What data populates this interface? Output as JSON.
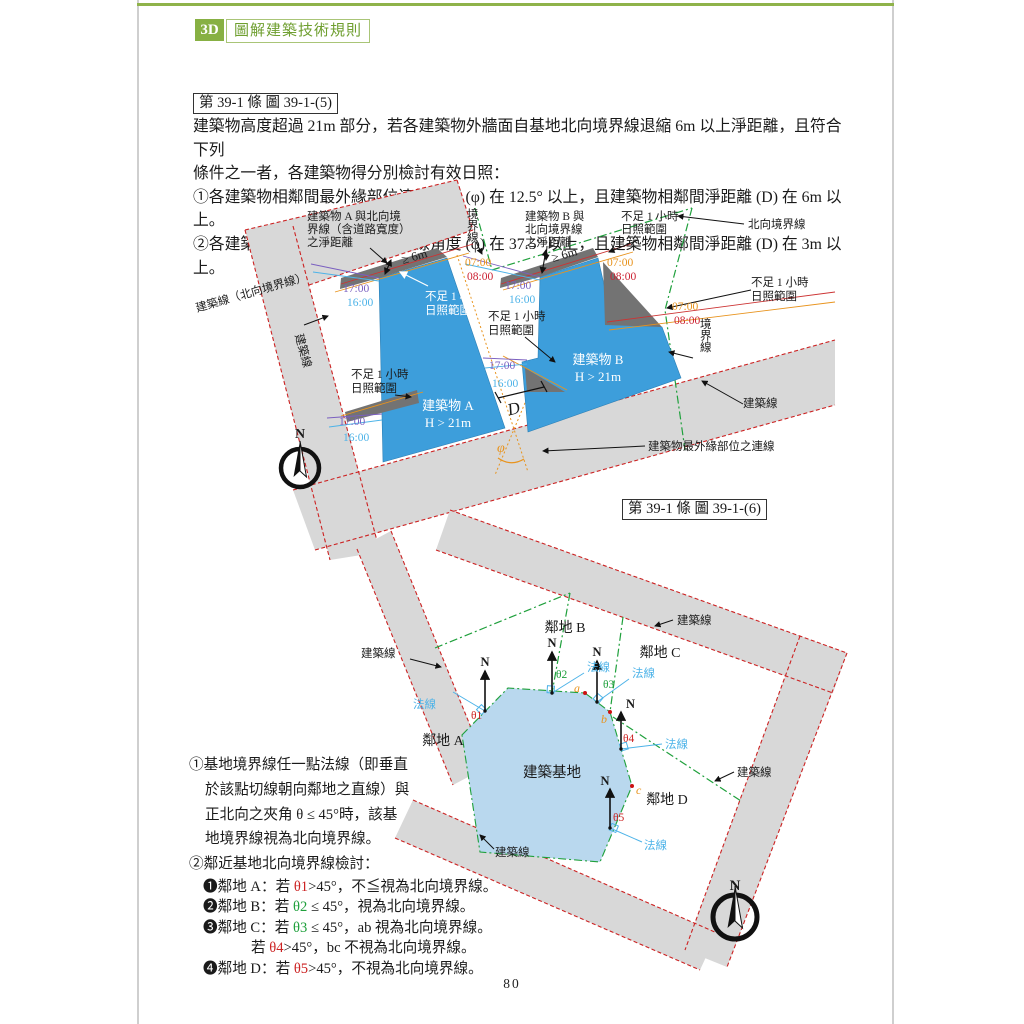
{
  "header": {
    "badge": "3D",
    "title": "圖解建築技術規則"
  },
  "page_number": "80",
  "section1": {
    "title": "第 39-1 條 圖 39-1-(5)",
    "body_lines": [
      "建築物高度超過 21m 部分，若各建築物外牆面自基地北向境界線退縮 6m 以上淨距離，且符合下列",
      "條件之一者，各建築物得分別檢討有效日照：",
      "①各建築物相鄰間最外緣部位連線角度 (φ) 在 12.5° 以上，且建築物相鄰間淨距離 (D) 在 6m 以上。",
      "②各建築物相鄰間最外緣部位連線角度 (φ) 在 37.5° 以上，且建築物相鄰間淨距離 (D) 在 3m 以上。"
    ]
  },
  "section2": {
    "title": "第 39-1 條 圖 39-1-(6)"
  },
  "notes": {
    "item1_lines": [
      "①基地境界線任一點法線（即垂直",
      "於該點切線朝向鄰地之直線）與",
      "正北向之夾角 θ ≤ 45°時，該基",
      "地境界線視為北向境界線。"
    ],
    "item2_title": "②鄰近基地北向境界線檢討：",
    "subitems": [
      {
        "pre": "❶鄰地 A：若 ",
        "theta": "θ1",
        "post": ">45°，不≦視為北向境界線。",
        "tc": "#cc2222"
      },
      {
        "pre": "❷鄰地 B：若 ",
        "theta": "θ2",
        "post": " ≤ 45°，視為北向境界線。",
        "tc": "#1fa03c"
      },
      {
        "pre": "❸鄰地 C：若 ",
        "theta": "θ3",
        "post": " ≤ 45°，ab 視為北向境界線。",
        "tc": "#1fa03c"
      },
      {
        "pre": "若 ",
        "theta": "θ4",
        "post": ">45°，bc 不視為北向境界線。",
        "tc": "#cc2222"
      },
      {
        "pre": "❹鄰地 D：若 ",
        "theta": "θ5",
        "post": ">45°，不視為北向境界線。",
        "tc": "#cc2222"
      }
    ]
  },
  "colors": {
    "road_gray": "#d8d8d8",
    "shadow_gray": "#737373",
    "building_blue": "#3d9edb",
    "site_blue": "#b9d8ee",
    "line_red": "#cc2222",
    "line_green": "#1fa03c",
    "sun_orange": "#e8931d",
    "sun_red": "#cc2233",
    "sun_purple": "#7a5fc0",
    "sun_cyan": "#4db3e8",
    "accent_green": "#87b043"
  },
  "diagram1": {
    "labels": [
      {
        "n": "label-dist-a",
        "t": "建築物 A 與北向境\n界線（含道路寬度）\n之淨距離",
        "x": 112,
        "y": 20,
        "lh": 13
      },
      {
        "n": "label-boundary-top",
        "t": "境界線",
        "x": 272,
        "y": 18,
        "v": true
      },
      {
        "n": "label-dist-b",
        "t": "建築物 B 與\n北向境界線\n之淨距離",
        "x": 330,
        "y": 20,
        "lh": 13
      },
      {
        "n": "label-insufficient-top-right",
        "t": "不足 1 小時\n日照範圍",
        "x": 426,
        "y": 20,
        "lh": 13
      },
      {
        "n": "label-north-boundary",
        "t": "北向境界線",
        "x": 553,
        "y": 28
      },
      {
        "n": "time-0700-a",
        "t": "07:00",
        "x": 270,
        "y": 66,
        "c": "#e8931d"
      },
      {
        "n": "time-0800-a",
        "t": "08:00",
        "x": 272,
        "y": 80,
        "c": "#cc2233"
      },
      {
        "n": "time-1700-a",
        "t": "17:00",
        "x": 148,
        "y": 92,
        "c": "#7a5fc0"
      },
      {
        "n": "time-1600-a",
        "t": "16:00",
        "x": 152,
        "y": 106,
        "c": "#4db3e8"
      },
      {
        "n": "time-1700-b",
        "t": "17:00",
        "x": 310,
        "y": 89,
        "c": "#7a5fc0"
      },
      {
        "n": "time-1600-b",
        "t": "16:00",
        "x": 314,
        "y": 103,
        "c": "#4db3e8"
      },
      {
        "n": "time-0700-b",
        "t": "07:00",
        "x": 412,
        "y": 66,
        "c": "#e8931d"
      },
      {
        "n": "time-0800-b",
        "t": "08:00",
        "x": 415,
        "y": 80,
        "c": "#cc2233"
      },
      {
        "n": "label-insufficient-on-a",
        "t": "不足 1 小時\n日照範圍",
        "x": 230,
        "y": 100,
        "c": "#ffffff",
        "lh": 14
      },
      {
        "n": "label-insufficient-mid",
        "t": "不足 1 小時\n日照範圍",
        "x": 293,
        "y": 120,
        "lh": 14
      },
      {
        "n": "label-insufficient-right",
        "t": "不足 1 小時\n日照範圍",
        "x": 556,
        "y": 86,
        "lh": 14
      },
      {
        "n": "label-insufficient-left",
        "t": "不足 1 小時\n日照範圍",
        "x": 156,
        "y": 178,
        "lh": 14
      },
      {
        "n": "time-1700-a2",
        "t": "17:00",
        "x": 144,
        "y": 225,
        "c": "#7a5fc0"
      },
      {
        "n": "time-1600-a2",
        "t": "16:00",
        "x": 148,
        "y": 241,
        "c": "#4db3e8"
      },
      {
        "n": "time-1700-bn",
        "t": "17:00",
        "x": 294,
        "y": 169,
        "c": "#7a5fc0"
      },
      {
        "n": "time-1600-bn",
        "t": "16:00",
        "x": 297,
        "y": 187,
        "c": "#4db3e8"
      },
      {
        "n": "label-building-a",
        "t": "建築物 A\nH > 21m",
        "x": 253,
        "y": 210,
        "c": "#ffffff",
        "a": "middle",
        "s": 13,
        "lh": 17
      },
      {
        "n": "label-building-b",
        "t": "建築物 B\nH > 21m",
        "x": 403,
        "y": 164,
        "c": "#ffffff",
        "a": "middle",
        "s": 13,
        "lh": 17
      },
      {
        "n": "label-distance-d",
        "t": "D",
        "x": 320,
        "y": 214,
        "s": 17,
        "i": true,
        "r": -14,
        "a": "middle"
      },
      {
        "n": "label-angle-phi",
        "t": "φ",
        "x": 302,
        "y": 252,
        "s": 14,
        "i": true,
        "c": "#e8931d"
      },
      {
        "n": "label-outer-edge-line",
        "t": "建築物最外緣部位之連線",
        "x": 453,
        "y": 250
      },
      {
        "n": "label-building-line-right",
        "t": "建築線",
        "x": 548,
        "y": 207
      },
      {
        "n": "label-boundary-right",
        "t": "境界線",
        "x": 505,
        "y": 128,
        "v": true
      },
      {
        "n": "label-building-line-north",
        "t": "建築線（北向境界線）",
        "x": 2,
        "y": 112,
        "r": -16
      },
      {
        "n": "label-building-line-left",
        "t": "建築線",
        "x": 100,
        "y": 135,
        "r": 75
      },
      {
        "n": "time-0700-right",
        "t": "07:00",
        "x": 477,
        "y": 110,
        "c": "#e8931d"
      },
      {
        "n": "time-0800-right",
        "t": "08:00",
        "x": 479,
        "y": 124,
        "c": "#cc2233"
      },
      {
        "n": "dim-6m-a",
        "t": "≥ 6m",
        "x": 208,
        "y": 64,
        "r": -16,
        "s": 12.5
      },
      {
        "n": "dim-6m-b",
        "t": "≥ 6m",
        "x": 358,
        "y": 62,
        "r": -16,
        "s": 12.5
      },
      {
        "n": "compass1-n",
        "t": "N",
        "x": 105,
        "y": 238,
        "s": 14,
        "w": true,
        "a": "middle"
      }
    ]
  },
  "diagram2": {
    "labels": [
      {
        "n": "label-plot-a",
        "t": "鄰地 A",
        "x": 88,
        "y": 240,
        "s": 14,
        "a": "middle"
      },
      {
        "n": "label-plot-b",
        "t": "鄰地 B",
        "x": 210,
        "y": 127,
        "s": 14,
        "a": "middle"
      },
      {
        "n": "label-plot-c",
        "t": "鄰地 C",
        "x": 305,
        "y": 152,
        "s": 14,
        "a": "middle"
      },
      {
        "n": "label-plot-d",
        "t": "鄰地 D",
        "x": 312,
        "y": 299,
        "s": 14,
        "a": "middle"
      },
      {
        "n": "label-site",
        "t": "建築基地",
        "x": 197,
        "y": 272,
        "s": 14.5,
        "a": "middle"
      },
      {
        "n": "label-building-line-top",
        "t": "建築線",
        "x": 322,
        "y": 119
      },
      {
        "n": "label-building-line-left",
        "t": "建築線",
        "x": 6,
        "y": 152
      },
      {
        "n": "label-building-line-right",
        "t": "建築線",
        "x": 382,
        "y": 271
      },
      {
        "n": "label-building-line-bottom",
        "t": "建築線",
        "x": 140,
        "y": 351
      },
      {
        "n": "north-1",
        "t": "N",
        "x": 130,
        "y": 161,
        "s": 12.5,
        "w": true,
        "a": "middle"
      },
      {
        "n": "north-2",
        "t": "N",
        "x": 197,
        "y": 142,
        "s": 12.5,
        "w": true,
        "a": "middle"
      },
      {
        "n": "north-3",
        "t": "N",
        "x": 242,
        "y": 151,
        "s": 12.5,
        "w": true,
        "a": "middle"
      },
      {
        "n": "north-4",
        "t": "N",
        "x": 271,
        "y": 203,
        "s": 12.5,
        "w": true
      },
      {
        "n": "north-5",
        "t": "N",
        "x": 250,
        "y": 280,
        "s": 12.5,
        "w": true,
        "a": "middle"
      },
      {
        "n": "normal-1",
        "t": "法線",
        "x": 58,
        "y": 203,
        "c": "#4db3e8"
      },
      {
        "n": "normal-2",
        "t": "法線",
        "x": 232,
        "y": 166,
        "c": "#4db3e8"
      },
      {
        "n": "normal-3",
        "t": "法線",
        "x": 277,
        "y": 172,
        "c": "#4db3e8"
      },
      {
        "n": "normal-4",
        "t": "法線",
        "x": 310,
        "y": 243,
        "c": "#4db3e8"
      },
      {
        "n": "normal-5",
        "t": "法線",
        "x": 289,
        "y": 344,
        "c": "#4db3e8"
      },
      {
        "n": "theta-1",
        "t": "θ1",
        "x": 116,
        "y": 214,
        "c": "#cc2222"
      },
      {
        "n": "theta-2",
        "t": "θ2",
        "x": 201,
        "y": 173,
        "c": "#1fa03c"
      },
      {
        "n": "theta-3",
        "t": "θ3",
        "x": 248,
        "y": 183,
        "c": "#1fa03c"
      },
      {
        "n": "theta-4",
        "t": "θ4",
        "x": 268,
        "y": 237,
        "c": "#cc2222"
      },
      {
        "n": "theta-5",
        "t": "θ5",
        "x": 258,
        "y": 316,
        "c": "#cc2222"
      },
      {
        "n": "point-a",
        "t": "a",
        "x": 219,
        "y": 187,
        "c": "#e8931d",
        "s": 12,
        "i": true
      },
      {
        "n": "point-b",
        "t": "b",
        "x": 246,
        "y": 218,
        "c": "#e8931d",
        "s": 12,
        "i": true
      },
      {
        "n": "point-c",
        "t": "c",
        "x": 281,
        "y": 289,
        "c": "#e8931d",
        "s": 12,
        "i": true
      },
      {
        "n": "compass2-n",
        "t": "N",
        "x": 380,
        "y": 385,
        "s": 15,
        "w": true,
        "a": "middle"
      }
    ]
  }
}
